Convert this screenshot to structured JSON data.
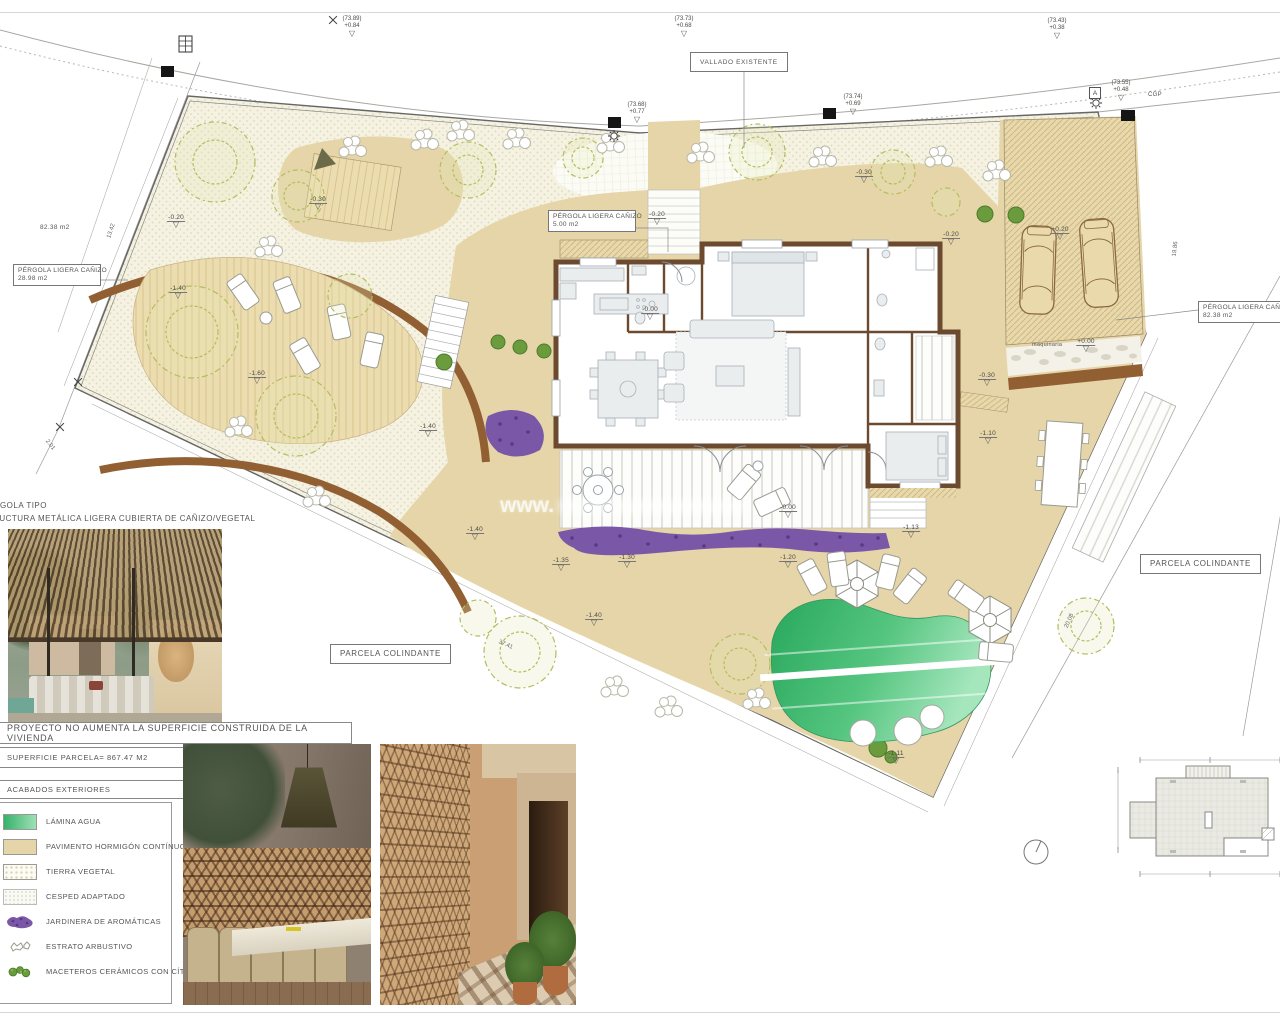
{
  "colors": {
    "pavement": "#e5d5a8",
    "wall_brown": "#6b4a2f",
    "path_brown": "#925f33",
    "pool_green": "#2fae5f",
    "jardinera_purple": "#7b57a8",
    "tree_olive": "#b3bd5e",
    "legend_border": "#9a9a94"
  },
  "plan": {
    "labels": {
      "vallado": "VALLADO EXISTENTE",
      "cgp": "CGP",
      "a_mark": "A",
      "maquinaria": "maquinaria",
      "parcela_left": "PARCELA COLINDANTE",
      "parcela_right": "PARCELA COLINDANTE",
      "pergola28_1": "PÉRGOLA LIGERA CAÑIZO",
      "pergola28_2": "28.98 m2",
      "pergola5_1": "PÉRGOLA LIGERA CAÑIZO",
      "pergola5_2": "5.00 m2",
      "pergola82_1": "PÉRGOLA LIGERA CAÑIZO",
      "pergola82_2": "82.38 m2",
      "area_left": "82.38 m2",
      "watermark": "www."
    },
    "benchmarks": [
      {
        "cota": "(73.89)",
        "delta": "+0.84"
      },
      {
        "cota": "(73.73)",
        "delta": "+0.68"
      },
      {
        "cota": "(73.43)",
        "delta": "+0.38"
      },
      {
        "cota": "(73.55)",
        "delta": "+0.48"
      },
      {
        "cota": "(73.68)",
        "delta": "+0.77"
      },
      {
        "cota": "(73.74)",
        "delta": "+0.69"
      }
    ],
    "elevations": [
      "-0.30",
      "-0.20",
      "-1.40",
      "-1.60",
      "-1.40",
      "-0.20",
      "-0.30",
      "-0.20",
      "-0.00",
      "-0.00",
      "-1.35",
      "-1.30",
      "-1.20",
      "-1.13",
      "-1.40",
      "-1.40",
      "-1.11",
      "+0.20",
      "+0.00",
      "-0.30",
      "-1.10"
    ],
    "dimensions": [
      "13.42",
      "37.41",
      "20.08",
      "19.86",
      "2.01"
    ]
  },
  "pergola_note": {
    "line1": "PÉRGOLA TIPO",
    "line2": "ESTRUCTURA METÁLICA LIGERA CUBIERTA DE CAÑIZO/VEGETAL"
  },
  "notes": {
    "project": "PROYECTO NO AUMENTA LA SUPERFICIE CONSTRUIDA DE LA VIVIENDA",
    "superficie": "SUPERFICIE PARCELA= 867.47 M2"
  },
  "legend": {
    "title": "ACABADOS EXTERIORES",
    "items": [
      {
        "label": "LÁMINA AGUA"
      },
      {
        "label": "PAVIMENTO HORMIGÓN CONTÍNUO"
      },
      {
        "label": "TIERRA VEGETAL"
      },
      {
        "label": "CESPED ADAPTADO"
      },
      {
        "label": "JARDINERA  DE AROMÁTICAS"
      },
      {
        "label": "ESTRATO ARBUSTIVO"
      },
      {
        "label": "MACETEROS CERÁMICOS CON CÍTRICOS"
      }
    ]
  }
}
